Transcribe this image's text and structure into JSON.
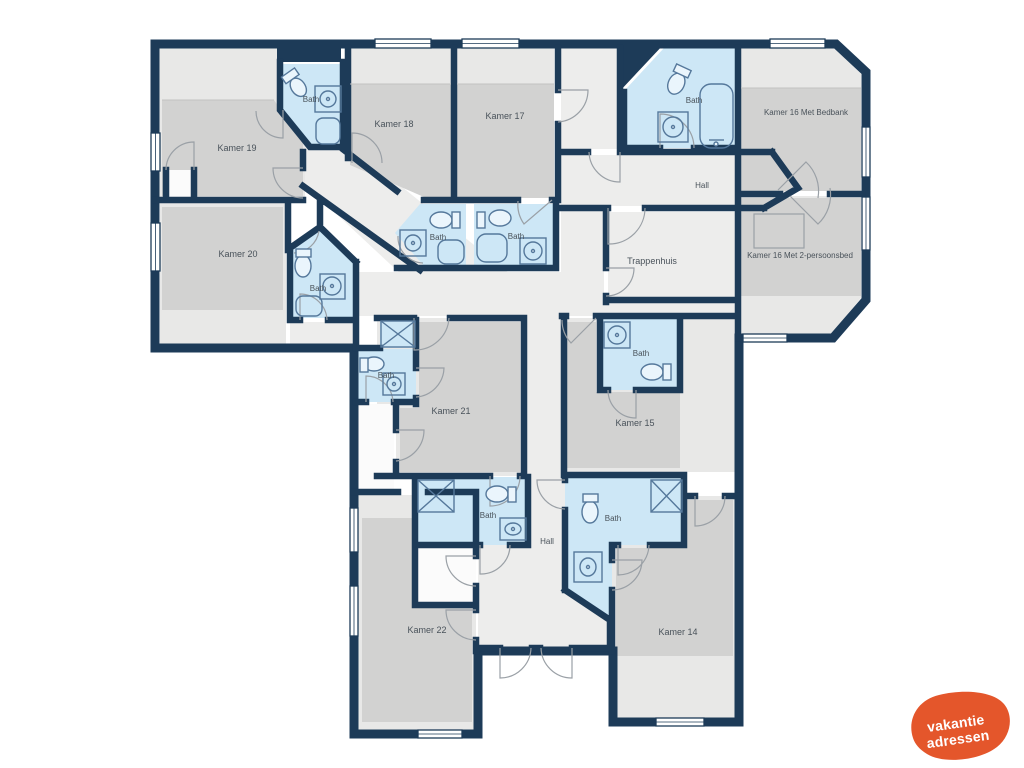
{
  "labels": {
    "kamer14": "Kamer 14",
    "kamer15": "Kamer 15",
    "kamer16_bedbank": "Kamer 16 Met Bedbank",
    "kamer16_2persoons": "Kamer 16 Met 2-persoonsbed",
    "kamer17": "Kamer 17",
    "kamer18": "Kamer 18",
    "kamer19": "Kamer 19",
    "kamer20": "Kamer 20",
    "kamer21": "Kamer 21",
    "kamer22": "Kamer 22",
    "bath": "Bath",
    "hall": "Hall",
    "trappenhuis": "Trappenhuis"
  },
  "logo": {
    "line1": "vakantie",
    "line2": "adressen"
  },
  "colors": {
    "wall": "#1d3b58",
    "room_dark": "#d2d2d1",
    "room_light": "#e8e8e7",
    "hall": "#ededec",
    "bath": "#cde7f6",
    "fixture": "#55789b",
    "label_text": "#49525a",
    "logo_background": "#e4562b",
    "logo_text": "#ffffff"
  }
}
